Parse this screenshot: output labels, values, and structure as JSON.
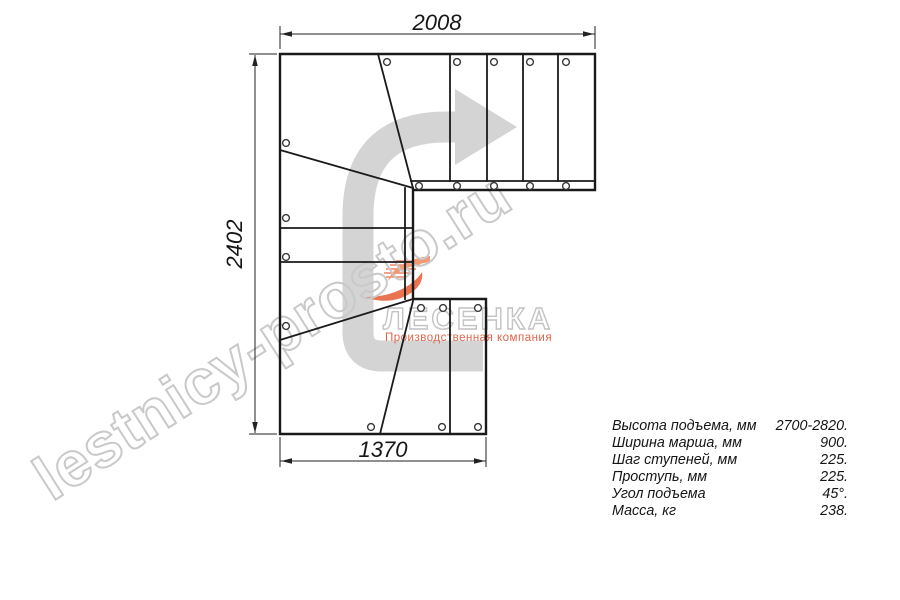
{
  "page": {
    "background": "#ffffff"
  },
  "drawing": {
    "title": "stair-plan-top-view",
    "dimensions": {
      "top": "2008",
      "left": "2402",
      "bottom": "1370"
    },
    "line_color": "#1a1a1a",
    "direction_arrow_color": "#d2d2d2"
  },
  "watermark": {
    "site": "lestnicy-prosto.ru",
    "brand": "ЛЕСЕНКА",
    "tagline": "Производственная компания",
    "outline_color": "#c9c9c9",
    "accent_color": "#e8663f"
  },
  "specs": {
    "rows": [
      {
        "label": "Высота подъема, мм",
        "value": "2700-2820."
      },
      {
        "label": "Ширина марша, мм",
        "value": "900."
      },
      {
        "label": "Шаг ступеней, мм",
        "value": "225."
      },
      {
        "label": "Проступь, мм",
        "value": "225."
      },
      {
        "label": "Угол подъема",
        "value": "45°."
      },
      {
        "label": "Масса, кг",
        "value": "238."
      }
    ]
  }
}
